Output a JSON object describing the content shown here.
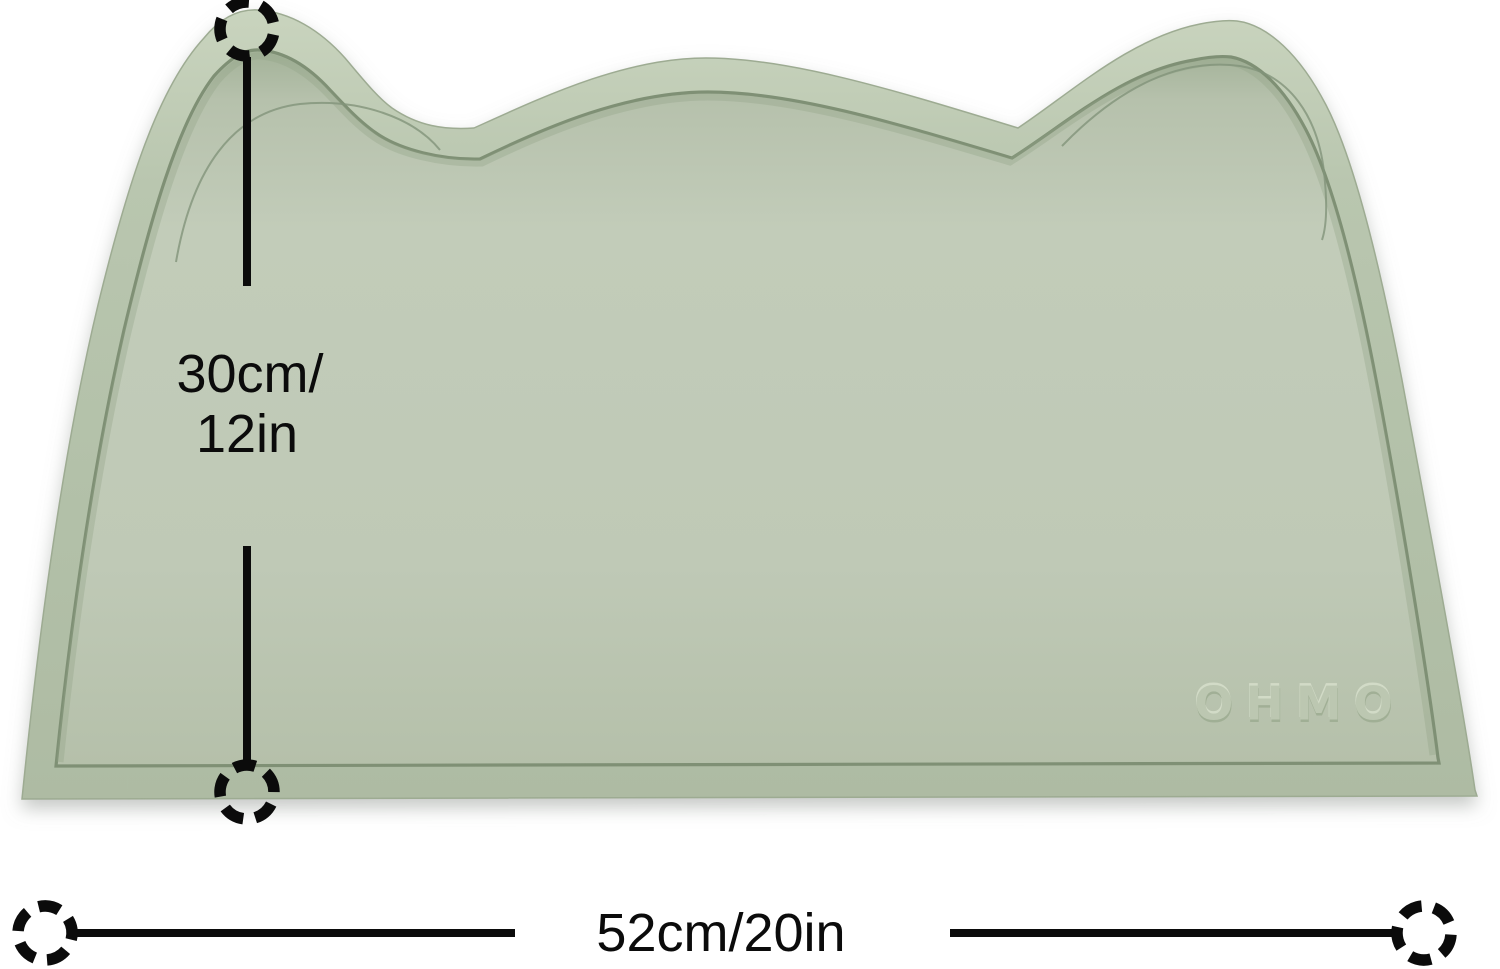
{
  "placemat": {
    "logo": "OHMO",
    "colors": {
      "surface": "#c0cab7",
      "rim": "#b7c4ae",
      "rim_highlight": "#c9d4be",
      "groove": "#7f9075",
      "edge": "#9dab92",
      "crease": "#82937a"
    }
  },
  "annotations": {
    "marker_icon": "dashed-circle-icon",
    "line_color": "#0b0b0b",
    "vertical_label_line1": "30cm/",
    "vertical_label_line2": "12in",
    "horizontal_label": "52cm/20in"
  }
}
